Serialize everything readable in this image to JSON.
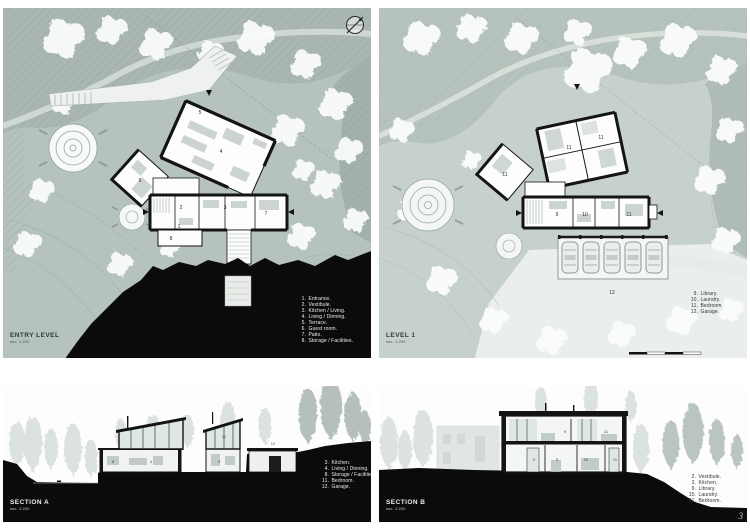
{
  "document": {
    "page_number": "3"
  },
  "panels": {
    "entry": {
      "title": "ENTRY LEVEL",
      "scale": "esc. 1:200",
      "legend": [
        {
          "num": "1.",
          "label": "Entrance."
        },
        {
          "num": "2.",
          "label": "Vestibule."
        },
        {
          "num": "3.",
          "label": "Kitchen / Living."
        },
        {
          "num": "4.",
          "label": "Living / Dinning."
        },
        {
          "num": "5.",
          "label": "Terrace."
        },
        {
          "num": "6.",
          "label": "Guest room."
        },
        {
          "num": "7.",
          "label": "Patio."
        },
        {
          "num": "8.",
          "label": "Storage / Facilities."
        }
      ],
      "plan_marks": [
        "1",
        "2",
        "3",
        "4",
        "5",
        "6",
        "7",
        "8"
      ]
    },
    "level1": {
      "title": "LEVEL 1",
      "scale": "esc. 1:200",
      "legend": [
        {
          "num": "9.",
          "label": "Library."
        },
        {
          "num": "10.",
          "label": "Laundry."
        },
        {
          "num": "11.",
          "label": "Bedroom."
        },
        {
          "num": "12.",
          "label": "Garage."
        }
      ],
      "plan_marks": [
        "11",
        "11",
        "11",
        "9",
        "10",
        "11",
        "12"
      ]
    },
    "sectionA": {
      "title": "SECTION A",
      "scale": "esc. 1:200",
      "legend": [
        {
          "num": "3.",
          "label": "Kitchen."
        },
        {
          "num": "4.",
          "label": "Living / Dinning."
        },
        {
          "num": "8.",
          "label": "Storage / Facilities."
        },
        {
          "num": "11.",
          "label": "Bedroom."
        },
        {
          "num": "12.",
          "label": "Garage."
        }
      ],
      "plan_marks": [
        "8",
        "4",
        "3",
        "11",
        "12"
      ]
    },
    "sectionB": {
      "title": "SECTION B",
      "scale": "esc. 1:200",
      "legend": [
        {
          "num": "2.",
          "label": "Vestibule."
        },
        {
          "num": "3.",
          "label": "Kitchen."
        },
        {
          "num": "9.",
          "label": "Library."
        },
        {
          "num": "10.",
          "label": "Laundry."
        },
        {
          "num": "11.",
          "label": "Bedroom."
        }
      ],
      "plan_marks": [
        "9",
        "11",
        "2",
        "3",
        "10",
        "11"
      ]
    }
  },
  "colors": {
    "site_bg_entry": "#b6c2be",
    "site_bg_level1": "#c7d1cc",
    "forest_band": "#a9b7b0",
    "plan_wall_ink": "#141414",
    "terrain_black": "#0b0b0b",
    "glazing": "#dfe7e2",
    "tree_white": "#fafcfa",
    "legend_text_dark": "#39433e",
    "legend_text_light": "#efefef"
  }
}
